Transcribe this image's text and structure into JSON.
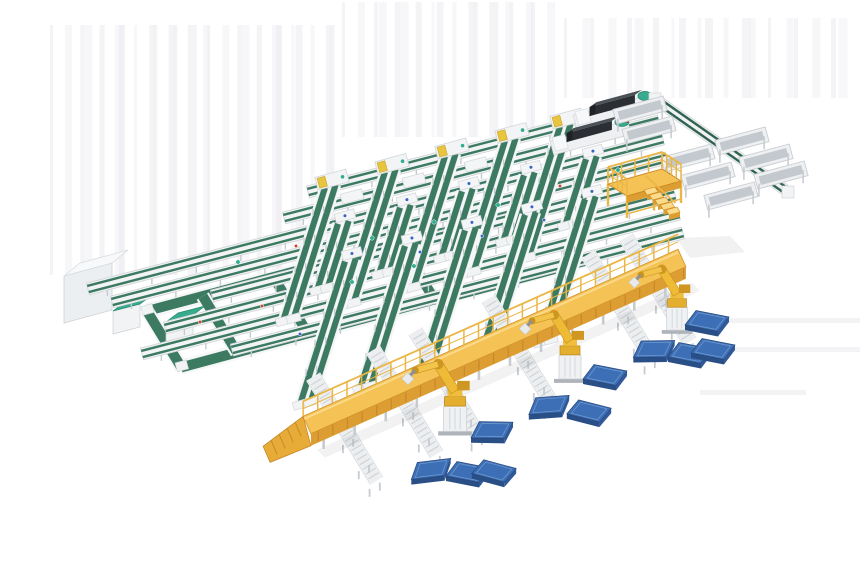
{
  "scene": {
    "canvas": {
      "w": 860,
      "h": 580,
      "bg": "#ffffff"
    },
    "palette": {
      "belt": "#3c7a61",
      "beltDark": "#2f6350",
      "beltEdge": "#f4f6f7",
      "frame": "#f1f3f5",
      "frameStroke": "#d3d7db",
      "frameShade": "#dfe3e6",
      "rollerLine": "#cdd2d6",
      "legGrey": "#c6cbcf",
      "deck": "#f5c255",
      "deckLight": "#fbda8a",
      "deckSide": "#dc9d32",
      "rail": "#eab644",
      "robot": "#efba36",
      "robotDark": "#cf9722",
      "pedestal": "#eff1f3",
      "blueTop": "#3d6fb6",
      "blueSide": "#2a4e86",
      "blueSide2": "#325a9b",
      "blueLine": "#6d96cc",
      "darkTop": "#4a5157",
      "darkFront": "#2b2f33",
      "darkNose": "#1f2326",
      "teal": "#36ab8d",
      "tealDark": "#2d8a72",
      "dotTeal": "#2fae8f",
      "dotRed": "#c2452f",
      "dotBlue": "#3a62c4",
      "artifact": "#f0f0f3",
      "artifact2": "#eaeaef",
      "shadow": "#ededef"
    },
    "dirs": {
      "lane": [
        0.966,
        -0.259
      ],
      "ramp": [
        -0.3,
        0.954
      ],
      "lower": [
        0.52,
        0.854
      ]
    },
    "lanes": [
      {
        "x1": 308,
        "y1": 192,
        "x2": 655,
        "y2": 102
      },
      {
        "x1": 284,
        "y1": 218,
        "x2": 659,
        "y2": 121
      },
      {
        "x1": 88,
        "y1": 289,
        "x2": 663,
        "y2": 139
      },
      {
        "x1": 112,
        "y1": 302,
        "x2": 667,
        "y2": 158
      },
      {
        "x1": 212,
        "y1": 296,
        "x2": 671,
        "y2": 177
      },
      {
        "x1": 165,
        "y1": 328,
        "x2": 675,
        "y2": 195
      },
      {
        "x1": 142,
        "y1": 354,
        "x2": 679,
        "y2": 214
      },
      {
        "x1": 232,
        "y1": 350,
        "x2": 683,
        "y2": 233
      }
    ],
    "rampBands": [
      {
        "lane": 0,
        "len": 140,
        "cols": [
          325,
          385,
          445,
          505,
          560
        ],
        "cover": "machine"
      },
      {
        "lane": 2,
        "len": 70,
        "cols": [
          338,
          400,
          462,
          524,
          586
        ],
        "cover": "small"
      },
      {
        "lane": 4,
        "len": 150,
        "cols": [
          345,
          405,
          465,
          525,
          585
        ],
        "cover": "small"
      }
    ],
    "extraCovers": [
      {
        "lane": 1,
        "cols": [
          352,
          414,
          476
        ]
      }
    ],
    "wideBelts": [
      {
        "x1": 147,
        "y1": 311,
        "x2": 545,
        "y2": 207
      },
      {
        "x1": 181,
        "y1": 367,
        "x2": 585,
        "y2": 260
      }
    ],
    "loop": {
      "tl": [
        147,
        311
      ],
      "ulen": 262,
      "vlen": 66,
      "beltW": 10,
      "cross": [
        0.22,
        0.5
      ]
    },
    "leftBox": {
      "front": [
        [
          64,
          276
        ],
        [
          112,
          263
        ],
        [
          112,
          310
        ],
        [
          64,
          323
        ]
      ],
      "ext": [
        16,
        -13
      ]
    },
    "tealMachines": [
      {
        "x": 113,
        "y": 311,
        "w": 27,
        "h": 23,
        "ext": [
          12,
          -9
        ]
      },
      {
        "x": 166,
        "y": 322,
        "w": 27,
        "h": 23,
        "ext": [
          12,
          -9
        ]
      }
    ],
    "darkMachines": [
      {
        "x": 575,
        "y": 122,
        "len": 80
      },
      {
        "x": 552,
        "y": 148,
        "len": 80
      }
    ],
    "combLine": {
      "x1": 655,
      "y1": 99,
      "x2": 788,
      "y2": 192,
      "troughs": [
        [
          640,
          110
        ],
        [
          649,
          130
        ],
        [
          688,
          158
        ],
        [
          708,
          176
        ],
        [
          731,
          196
        ],
        [
          742,
          141
        ],
        [
          766,
          158
        ],
        [
          781,
          175
        ]
      ]
    },
    "mezzanine": {
      "p1": [
        608,
        184
      ],
      "p2": [
        662,
        169
      ],
      "p3": [
        681,
        181
      ],
      "p4": [
        627,
        196
      ],
      "legH": 22,
      "railH": 17,
      "stairStart": [
        644,
        190
      ],
      "steps": 5
    },
    "walkway": {
      "x1": 307,
      "y1": 425,
      "x2": 682,
      "y2": 258,
      "deckW": 19,
      "sideH": 12,
      "railH": 15,
      "ramp": {
        "dx": -40,
        "dy": 30
      }
    },
    "stubs": [
      335,
      395,
      437,
      510,
      610,
      648
    ],
    "robots": [
      {
        "x": 455,
        "s": 1.05
      },
      {
        "x": 570,
        "s": 1.0
      },
      {
        "x": 677,
        "s": 0.95
      }
    ],
    "panels": [
      [
        431,
        469,
        -18
      ],
      [
        468,
        472,
        0
      ],
      [
        494,
        471,
        4
      ],
      [
        492,
        430,
        -10
      ],
      [
        549,
        405,
        -15
      ],
      [
        589,
        411,
        3
      ],
      [
        605,
        375,
        0
      ],
      [
        654,
        349,
        -12
      ],
      [
        690,
        353,
        0
      ],
      [
        713,
        349,
        0
      ],
      [
        707,
        321,
        0
      ]
    ],
    "dots": [
      [
        238,
        262,
        "t"
      ],
      [
        296,
        246,
        "r"
      ],
      [
        372,
        238,
        "t"
      ],
      [
        434,
        222,
        "t"
      ],
      [
        498,
        205,
        "t"
      ],
      [
        200,
        322,
        "r"
      ],
      [
        262,
        306,
        "r"
      ],
      [
        420,
        252,
        "b"
      ],
      [
        482,
        236,
        "b"
      ],
      [
        544,
        220,
        "b"
      ],
      [
        352,
        282,
        "t"
      ],
      [
        414,
        266,
        "t"
      ],
      [
        560,
        186,
        "r"
      ],
      [
        618,
        170,
        "t"
      ],
      [
        300,
        334,
        "b"
      ]
    ],
    "artifacts": {
      "vRegions": [
        {
          "x": 55,
          "y": 25,
          "w": 290,
          "h": 250,
          "n": 26
        },
        {
          "x": 345,
          "y": 2,
          "w": 215,
          "h": 135,
          "n": 18
        },
        {
          "x": 565,
          "y": 18,
          "w": 290,
          "h": 80,
          "n": 20
        }
      ],
      "hLines": [
        [
          688,
          318,
          860
        ],
        [
          706,
          347,
          860
        ],
        [
          700,
          390,
          806
        ]
      ],
      "wedge": [
        [
          676,
          238
        ],
        [
          730,
          236
        ],
        [
          745,
          252
        ],
        [
          690,
          258
        ]
      ]
    }
  }
}
